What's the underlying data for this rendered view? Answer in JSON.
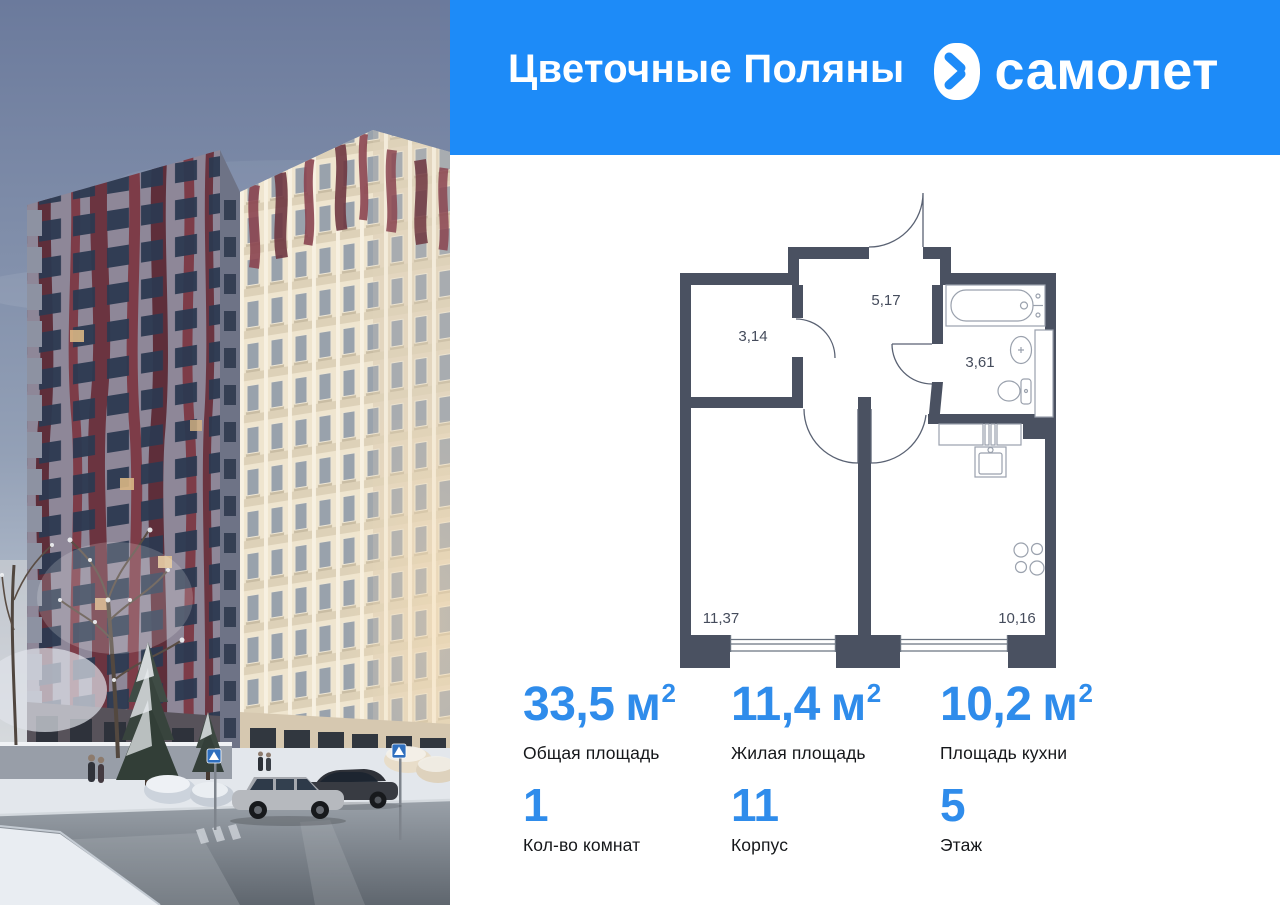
{
  "brand": {
    "project_title": "Цветочные Поляны",
    "logo_text": "самолет",
    "blue": "#1d8bf8"
  },
  "photo": {
    "scene": "winter-residential-towers",
    "colors": {
      "sky_top": "#6b7a9c",
      "left_facade": "#8e8798",
      "maroon_stripe": "#6b3440",
      "cream_facade": "#efe5cf",
      "snow": "#e3e7ec"
    }
  },
  "plan": {
    "wall_color": "#4a5161",
    "rooms": [
      {
        "name": "hallway",
        "area": "5,17"
      },
      {
        "name": "wardrobe",
        "area": "3,14"
      },
      {
        "name": "bathroom",
        "area": "3,61"
      },
      {
        "name": "living-room",
        "area": "11,37"
      },
      {
        "name": "kitchen",
        "area": "10,16"
      }
    ]
  },
  "stats": {
    "row1": [
      {
        "value": "33,5",
        "unit": "м",
        "sup": "2",
        "label": "Общая площадь"
      },
      {
        "value": "11,4",
        "unit": "м",
        "sup": "2",
        "label": "Жилая площадь"
      },
      {
        "value": "10,2",
        "unit": "м",
        "sup": "2",
        "label": "Площадь кухни"
      }
    ],
    "row2": [
      {
        "value": "1",
        "label": "Кол-во комнат"
      },
      {
        "value": "11",
        "label": "Корпус"
      },
      {
        "value": "5",
        "label": "Этаж"
      }
    ]
  }
}
